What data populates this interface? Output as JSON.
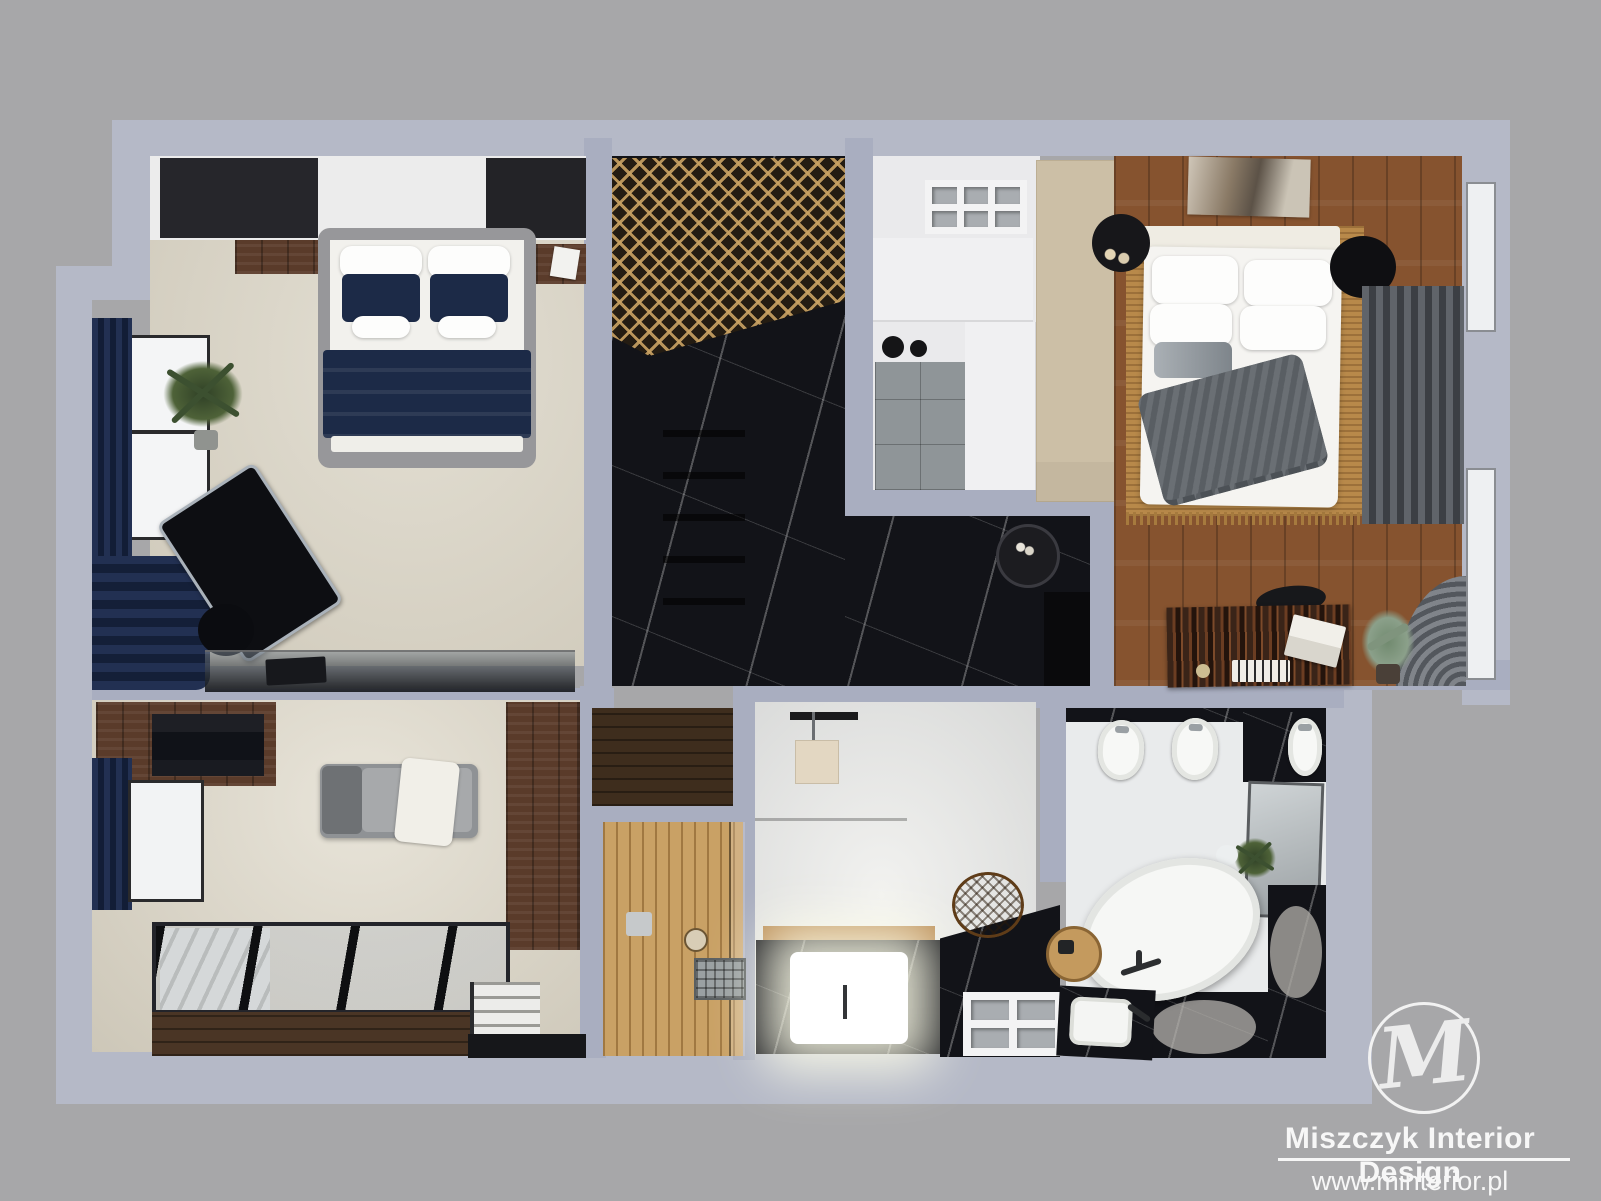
{
  "scene": {
    "type": "3D interior floor plan render, top-down dollhouse view",
    "background_color": "#a7a7a9",
    "wall_color": "#a9aec0"
  },
  "branding": {
    "monogram": "M",
    "company": "Miszczyk Interior Design",
    "website": "www.minterior.pl",
    "text_color": "#f7f7f7"
  },
  "palette": {
    "black_marble": "#121318",
    "walnut_wood": "#5a3b2a",
    "sauna_wood": "#c9a165",
    "bedroom_oak_floor": "#86532f",
    "jute_rug": "#b8894a",
    "navy_textile": "#1c2a47",
    "cream_carpet": "#d9d4c6",
    "gray_curtain": "#4c5056",
    "beige_wardrobe": "#ccbfa6"
  },
  "rooms": [
    {
      "id": "bedroom-navy",
      "label": "Bedroom with navy accents",
      "contents": "gray double bed with white bedding, two navy pillows and navy throw; built-in dark wardrobe with walnut shelf; nightstand with magazine; potted plant by window; navy pleated curtains; glass desk with laptop; black office chair; black floor lamp; cream carpet"
    },
    {
      "id": "hallway-wardrobe",
      "label": "Hallway / wardrobe corridor",
      "contents": "black marble floor; woven rattan ceiling panel; wardrobe drawer fronts; round side table with trinkets; dark console recess"
    },
    {
      "id": "kitchenette-utility",
      "label": "Kitchenette / utility room",
      "contents": "white cubby shelving (3x2); white cabinets; two-burner cooktop; gray stone tile floor; tall white column; beige wardrobe panel"
    },
    {
      "id": "bedroom-master",
      "label": "Master bedroom",
      "contents": "white double bed with many pillows, gray fringed throw; jute rug; abstract artwork above headboard; black bedside disc with dried flowers; black round pouf; gray pleated curtains over two windows; ebony sideboard desk with laptop, books and knob; desk chair; eucalyptus plant; hardwood plank floor"
    },
    {
      "id": "lounge-mezzanine",
      "label": "Lounge / mezzanine",
      "contents": "walnut display cabinet with black glass front; chaise lounge with white throw; tall walnut wardrobe; glass skylight with black beams over staircase; white stairs with black mat; navy curtain and window; cream carpet"
    },
    {
      "id": "sauna",
      "label": "Sauna",
      "contents": "light wood slat benches; sauna heater grate; round light; glass door strip; dark walnut entry floor"
    },
    {
      "id": "bathroom-spa",
      "label": "Spa bathroom",
      "contents": "illuminated soaking tub framed in black marble with wood rim; hanging beige light panel; black marble counter; orange wicker basket; white cube shelf (2x2); glass partition"
    },
    {
      "id": "bathroom-main",
      "label": "Main bathroom",
      "contents": "freestanding white oval bathtub with dark faucet; toilet and bidet; black marble wall panel; leaning gray mirror; green plant; round wooden tray with accessories; black marble vanity with white sink; black marble floor patches"
    }
  ]
}
